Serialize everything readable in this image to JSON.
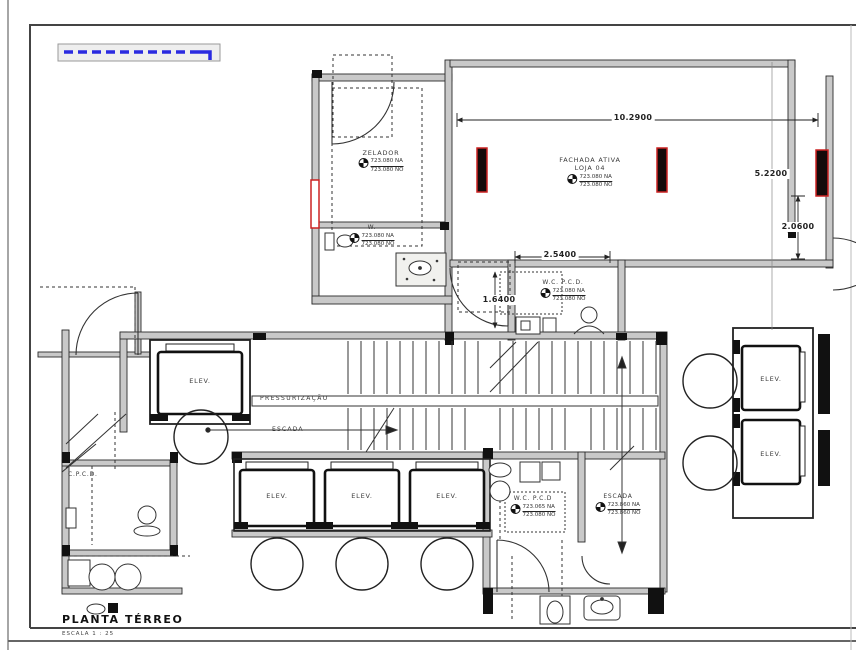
{
  "drawing": {
    "title": "PLANTA TÉRREO",
    "scale": "ESCALA 1 : 25"
  },
  "labels": {
    "zelador": {
      "name": "ZELADOR",
      "na": "723.080 NA",
      "no": "723.080 NO"
    },
    "fachada": {
      "line1": "FACHADA ATIVA",
      "line2": "LOJA 04",
      "na": "723.080 NA",
      "no": "723.080 NO"
    },
    "w": {
      "name": "W.",
      "na": "723.080 NA",
      "no": "723.080 NO"
    },
    "wc_center": {
      "name": "W.C. P.C.D.",
      "na": "723.080 NA",
      "no": "723.080 NO"
    },
    "pressurizacao": "PRESSURIZAÇÃO",
    "escada_mid": "ESCADA",
    "elev": "ELEV.",
    "cpcd": "C.P.C.D.",
    "wc_bottom": {
      "name": "W.C. P.C.D",
      "na": "723.065 NA",
      "no": "723.080 NO"
    },
    "escada_bottom": {
      "name": "ESCADA",
      "na": "723.860 NA",
      "no": "723.860 NO"
    }
  },
  "dimensions": {
    "loja_width": "10.2900",
    "right_bay": "5.2200",
    "right_door": "2.0600",
    "wc_width": "2.5400",
    "wc_depth": "1.6400"
  },
  "colors": {
    "wall_fill": "#c9c9c9",
    "line": "#2b2b2b",
    "column_red": "#cc2222",
    "awning_blue": "#2a2ae0"
  }
}
